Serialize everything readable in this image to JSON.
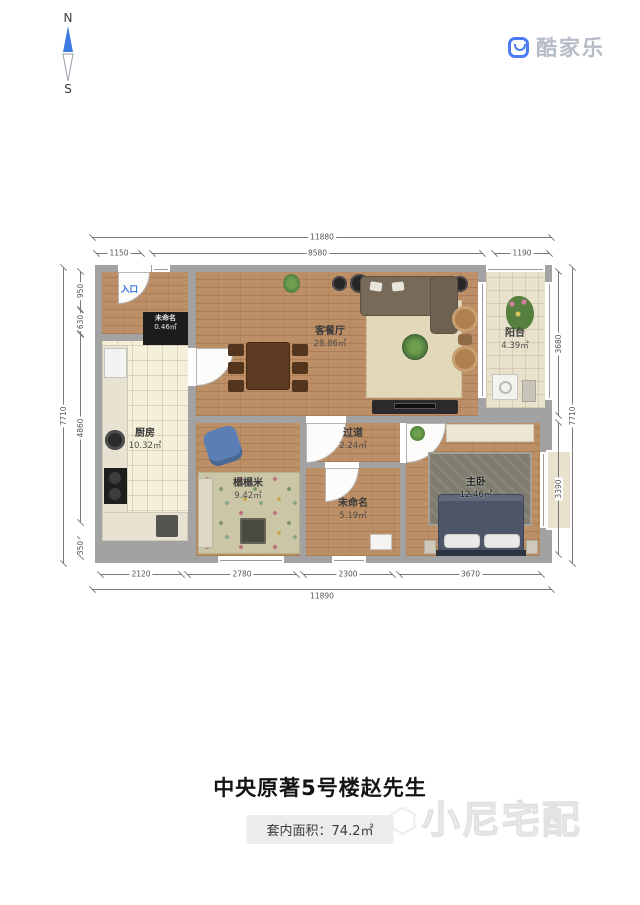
{
  "compass": {
    "north": "N",
    "south": "S"
  },
  "brand": {
    "name": "酷家乐"
  },
  "plan": {
    "entrance": "入口",
    "rooms": {
      "living": {
        "name": "客餐厅",
        "area": "28.86㎡"
      },
      "balcony": {
        "name": "阳台",
        "area": "4.39㎡"
      },
      "kitchen": {
        "name": "厨房",
        "area": "10.32㎡"
      },
      "hallway": {
        "name": "过道",
        "area": "2.24㎡"
      },
      "tatami": {
        "name": "榻榻米",
        "area": "9.42㎡"
      },
      "unnamed": {
        "name": "未命名",
        "area": "5.19㎡"
      },
      "master": {
        "name": "主卧",
        "area": "12.46㎡"
      },
      "closet": {
        "name": "未命名",
        "area": "0.46㎡"
      }
    },
    "dims": {
      "top_overall": "11880",
      "top_segments": [
        "1150",
        "8580",
        "1190"
      ],
      "bottom_segments": [
        "2120",
        "2780",
        "2300",
        "3670"
      ],
      "bottom_overall": "11890",
      "left_overall": "7710",
      "left_segments": [
        "950",
        "630",
        "4860",
        "350"
      ],
      "right_segments": [
        "3680",
        "3390"
      ],
      "right_overall": "7710"
    }
  },
  "footer": {
    "title": "中央原著5号楼赵先生",
    "area_text": "套内面积：74.2㎡",
    "watermark": "小尼宅配"
  },
  "colors": {
    "brand_blue": "#4a7df5",
    "compass_blue": "#3d7be0",
    "wall_gray": "#a2a2a2",
    "wood_floor": "#bd8f66",
    "entrance_blue": "#2f6fe4"
  }
}
